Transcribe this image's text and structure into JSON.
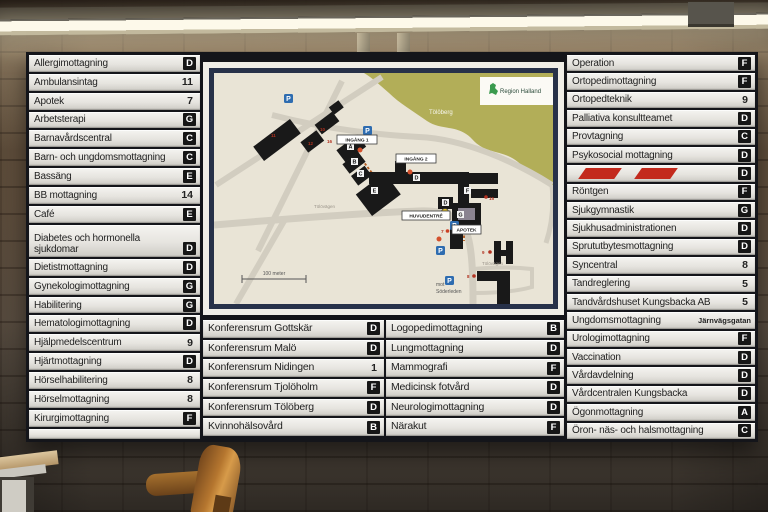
{
  "directory": {
    "left": [
      {
        "label": "Allergimottagning",
        "badge": "D",
        "type": "letter"
      },
      {
        "label": "Ambulansintag",
        "badge": "11",
        "type": "number"
      },
      {
        "label": "Apotek",
        "badge": "7",
        "type": "number"
      },
      {
        "label": "Arbetsterapi",
        "badge": "G",
        "type": "letter"
      },
      {
        "label": "Barnavårdscentral",
        "badge": "C",
        "type": "letter"
      },
      {
        "label": "Barn- och ungdomsmottagning",
        "badge": "C",
        "type": "letter"
      },
      {
        "label": "Bassäng",
        "badge": "E",
        "type": "letter"
      },
      {
        "label": "BB mottagning",
        "badge": "14",
        "type": "number"
      },
      {
        "label": "Café",
        "badge": "E",
        "type": "letter"
      },
      {
        "label": "Diabetes och hormonella sjukdomar",
        "badge": "D",
        "type": "letter",
        "tall": true
      },
      {
        "label": "Dietistmottagning",
        "badge": "D",
        "type": "letter"
      },
      {
        "label": "Gynekologimottagning",
        "badge": "G",
        "type": "letter"
      },
      {
        "label": "Habilitering",
        "badge": "G",
        "type": "letter"
      },
      {
        "label": "Hematologimottagning",
        "badge": "D",
        "type": "letter"
      },
      {
        "label": "Hjälpmedelscentrum",
        "badge": "9",
        "type": "number"
      },
      {
        "label": "Hjärtmottagning",
        "badge": "D",
        "type": "letter"
      },
      {
        "label": "Hörselhabilitering",
        "badge": "8",
        "type": "number"
      },
      {
        "label": "Hörselmottagning",
        "badge": "8",
        "type": "number"
      },
      {
        "label": "Kirurgimottagning",
        "badge": "F",
        "type": "letter"
      },
      {
        "label": "",
        "badge": "",
        "type": "blank"
      }
    ],
    "bottom_left": [
      {
        "label": "Konferensrum Gottskär",
        "badge": "D",
        "type": "letter"
      },
      {
        "label": "Konferensrum Malö",
        "badge": "D",
        "type": "letter"
      },
      {
        "label": "Konferensrum Nidingen",
        "badge": "1",
        "type": "number"
      },
      {
        "label": "Konferensrum Tjolöholm",
        "badge": "F",
        "type": "letter"
      },
      {
        "label": "Konferensrum Tölöberg",
        "badge": "D",
        "type": "letter"
      },
      {
        "label": "Kvinnohälsovård",
        "badge": "B",
        "type": "letter"
      }
    ],
    "bottom_right": [
      {
        "label": "Logopedimottagning",
        "badge": "B",
        "type": "letter"
      },
      {
        "label": "Lungmottagning",
        "badge": "D",
        "type": "letter"
      },
      {
        "label": "Mammografi",
        "badge": "F",
        "type": "letter"
      },
      {
        "label": "Medicinsk fotvård",
        "badge": "D",
        "type": "letter"
      },
      {
        "label": "Neurologimottagning",
        "badge": "D",
        "type": "letter"
      },
      {
        "label": "Närakut",
        "badge": "F",
        "type": "letter"
      }
    ],
    "right": [
      {
        "label": "Operation",
        "badge": "F",
        "type": "letter"
      },
      {
        "label": "Ortopedimottagning",
        "badge": "F",
        "type": "letter"
      },
      {
        "label": "Ortopedteknik",
        "badge": "9",
        "type": "number"
      },
      {
        "label": "Palliativa konsultteamet",
        "badge": "D",
        "type": "letter"
      },
      {
        "label": "Provtagning",
        "badge": "C",
        "type": "letter"
      },
      {
        "label": "Psykosocial mottagning",
        "badge": "D",
        "type": "letter"
      },
      {
        "label": "",
        "badge": "D",
        "type": "stripes"
      },
      {
        "label": "Röntgen",
        "badge": "F",
        "type": "letter"
      },
      {
        "label": "Sjukgymnastik",
        "badge": "G",
        "type": "letter"
      },
      {
        "label": "Sjukhusadministrationen",
        "badge": "D",
        "type": "letter"
      },
      {
        "label": "Sprututbytesmottagning",
        "badge": "D",
        "type": "letter"
      },
      {
        "label": "Syncentral",
        "badge": "8",
        "type": "number"
      },
      {
        "label": "Tandreglering",
        "badge": "5",
        "type": "number"
      },
      {
        "label": "Tandvårdshuset Kungsbacka AB",
        "badge": "5",
        "type": "number"
      },
      {
        "label": "Ungdomsmottagning",
        "badge": "Järnvägsgatan",
        "type": "street"
      },
      {
        "label": "Urologimottagning",
        "badge": "F",
        "type": "letter"
      },
      {
        "label": "Vaccination",
        "badge": "D",
        "type": "letter"
      },
      {
        "label": "Vårdavdelning",
        "badge": "D",
        "type": "letter"
      },
      {
        "label": "Vårdcentralen Kungsbacka",
        "badge": "D",
        "type": "letter"
      },
      {
        "label": "Ögonmottagning",
        "badge": "A",
        "type": "letter"
      },
      {
        "label": "Öron- näs- och halsmottagning",
        "badge": "C",
        "type": "letter"
      }
    ]
  },
  "map": {
    "logo_label": "Region Halland",
    "hill_label": "Tölöberg",
    "entrance1": "INGÅNG 1",
    "entrance2": "INGÅNG 2",
    "main_entrance": "HUVUDENTRÉ",
    "pharmacy": "APOTEK",
    "scale_label": "100 meter",
    "direction_line1": "mot",
    "direction_line2": "Söderleden",
    "street_label": "Tölövägen",
    "parking_label": "P",
    "letters": {
      "a": "A",
      "b": "B",
      "c": "C",
      "e": "E",
      "d": "D",
      "d2": "D",
      "f": "F",
      "g": "G"
    },
    "markers": {
      "m7": "7",
      "m8": "8",
      "m9": "9",
      "m10": "10",
      "m11": "11",
      "m12": "12",
      "m15": "15",
      "m16": "16"
    }
  },
  "colors": {
    "badge_bg": "#161616",
    "stripe_red": "#c32a1d",
    "parking_blue": "#2e6cb0",
    "hill_olive": "#b2ae58",
    "map_beige": "#e9e4d6",
    "frame_navy": "#273149",
    "logo_green": "#3a9a4e"
  }
}
